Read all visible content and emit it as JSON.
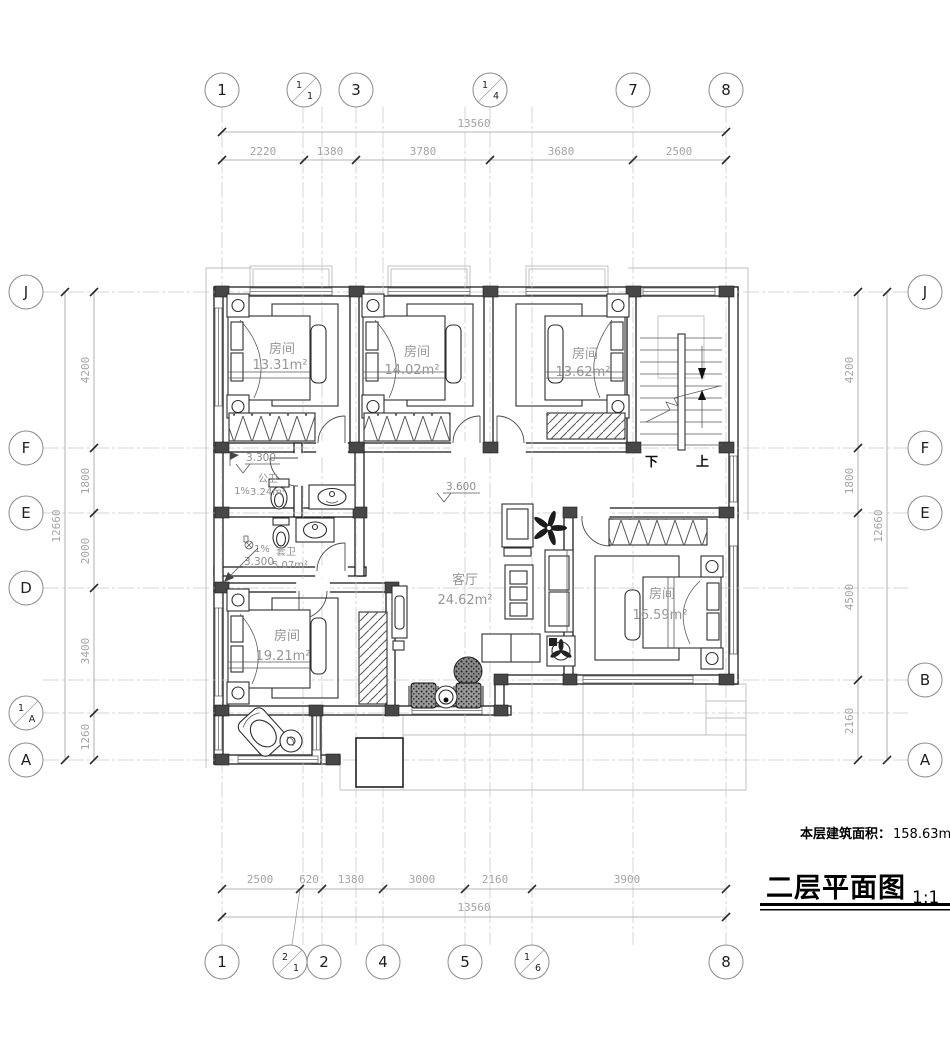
{
  "title_block": {
    "area_label": "本层建筑面积：",
    "area_value": "158.63m²",
    "title": "二层平面图",
    "scale": "1:1"
  },
  "dimensions": {
    "top": {
      "total": "13560",
      "segments": [
        "2220",
        "1380",
        "3780",
        "3680",
        "2500"
      ]
    },
    "bottom": {
      "total": "13560",
      "segments": [
        "2500",
        "620",
        "1380",
        "3000",
        "2160",
        "3900"
      ]
    },
    "left": {
      "total": "12660",
      "segments": [
        "4200",
        "1800",
        "2000",
        "3400",
        "1260"
      ]
    },
    "right": {
      "total": "12660",
      "segments": [
        "4200",
        "1800",
        "4500",
        "2160"
      ]
    }
  },
  "axes": {
    "top": [
      {
        "text": "1"
      },
      {
        "a": "1",
        "b": "1"
      },
      {
        "text": "3"
      },
      {
        "a": "1",
        "b": "4"
      },
      {
        "text": "7"
      },
      {
        "text": "8"
      }
    ],
    "bottom": [
      {
        "text": "1"
      },
      {
        "a": "2",
        "b": "1"
      },
      {
        "text": "2"
      },
      {
        "text": "4"
      },
      {
        "text": "5"
      },
      {
        "a": "1",
        "b": "6"
      },
      {
        "text": "8"
      }
    ],
    "left": [
      {
        "text": "J"
      },
      {
        "text": "F"
      },
      {
        "text": "E"
      },
      {
        "text": "D"
      },
      {
        "a": "1",
        "b": "A"
      },
      {
        "text": "A"
      }
    ],
    "right": [
      {
        "text": "J"
      },
      {
        "text": "F"
      },
      {
        "text": "E"
      },
      {
        "text": "B"
      },
      {
        "text": "A"
      }
    ]
  },
  "rooms": {
    "bedroom1": {
      "name": "房间",
      "area": "13.31m²"
    },
    "bedroom2": {
      "name": "房间",
      "area": "14.02m²"
    },
    "bedroom3": {
      "name": "房间",
      "area": "13.62m²"
    },
    "bedroom4": {
      "name": "房间",
      "area": "19.21m²"
    },
    "bedroom5": {
      "name": "房间",
      "area": "16.59m²"
    },
    "living": {
      "name": "客厅",
      "area": "24.62m²"
    },
    "bath_public": {
      "name": "公卫",
      "area": "3.24m²",
      "level": "3.300",
      "slope": "1%"
    },
    "bath_suite": {
      "name": "套卫",
      "area": "5.07m²",
      "level": "3.300",
      "slope": "1%"
    }
  },
  "annotations": {
    "hall_level": "3.600",
    "stair_down": "下",
    "stair_up": "上"
  }
}
